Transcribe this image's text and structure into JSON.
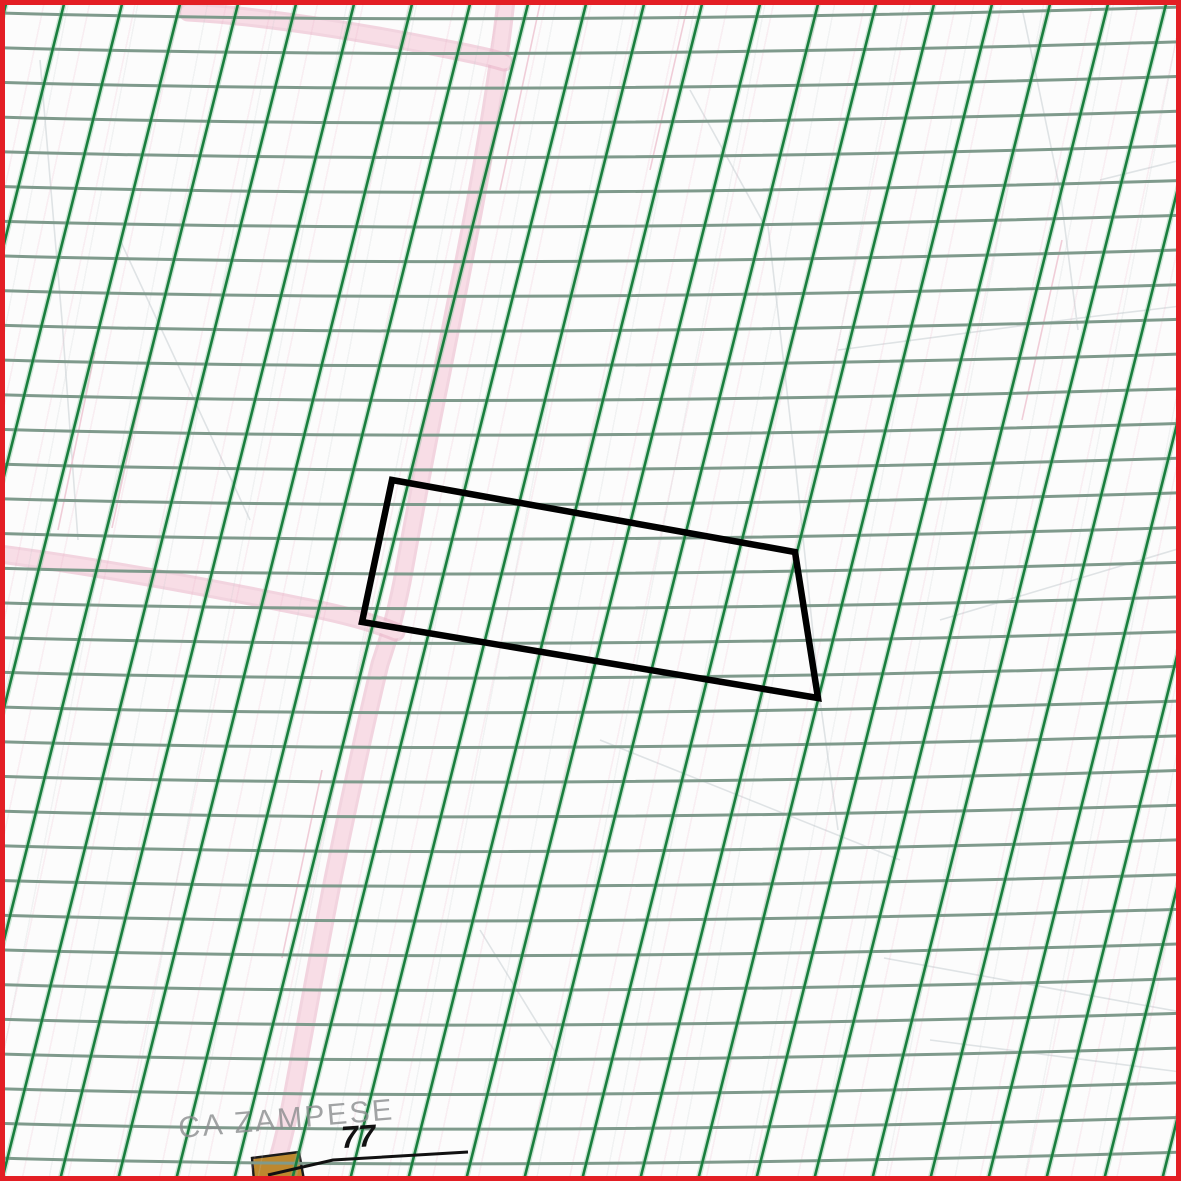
{
  "map": {
    "type": "cadastral-map-viewport",
    "labels": {
      "place": "CA ZAMPESE",
      "parcel_number": "77"
    },
    "colors": {
      "background": "#fcfcfc",
      "frame": "#e31e24",
      "grid_horizontal": "#7f9a8c",
      "grid_diagonal": "#1a7e3e",
      "grid_diagonal_halo": "rgba(105,185,135,0.32)",
      "road_fill": "#f8dde6",
      "road_edge": "#eab3c6",
      "selection_outline": "#000000",
      "leader": "#111111",
      "building_fill": "#bd882f",
      "building_outline": "#1a1a1a",
      "place_label": "#8b8d8f",
      "parcel_number": "#111111",
      "faint_gray": "#dfe3e5",
      "faint_pink": "#f0cdd8"
    },
    "grid": {
      "horizontal_spacing": 34.7,
      "horizontal_width": 3,
      "horizontal_phase": 13,
      "diagonal_spacing_x": 58,
      "diagonal_slope": -4,
      "diagonal_width": 2.6,
      "diagonal_halo_width": 5.5,
      "diagonal_phase": 10
    },
    "selection_polygon_points": "392,480 795,552 818,698 362,622",
    "building_points": "252,1158 299,1152 304,1180 254,1181",
    "leader_points": "268,1175 333,1160 468,1152",
    "roads": [
      {
        "name": "road-main-north-south",
        "d": "M 506,0 C 492,130 462,270 442,372 C 428,440 416,505 402,582 C 394,622 386,646 380,664 C 366,722 348,806 334,874 C 320,944 304,1034 290,1108 C 283,1144 276,1166 271,1181"
      },
      {
        "name": "road-branch-top",
        "d": "M 188,12 C 262,16 362,32 442,48 C 468,53 492,58 504,62"
      },
      {
        "name": "road-branch-left",
        "d": "M 0,554 C 92,566 202,586 300,606 C 342,614 372,622 396,632"
      }
    ],
    "faint_lines": [
      {
        "d": "M 40,60 L 62,320 L 78,540",
        "tone": "gray"
      },
      {
        "d": "M 120,240 L 250,520",
        "tone": "gray"
      },
      {
        "d": "M 768,226 L 796,470 L 820,700 L 838,830",
        "tone": "gray"
      },
      {
        "d": "M 690,90 L 764,224",
        "tone": "gray"
      },
      {
        "d": "M 838,350 L 1080,318 L 1181,306",
        "tone": "gray"
      },
      {
        "d": "M 884,958 L 1181,1012",
        "tone": "gray"
      },
      {
        "d": "M 930,1040 L 1181,1072",
        "tone": "gray"
      },
      {
        "d": "M 1022,8 L 1060,190 L 1078,330",
        "tone": "gray"
      },
      {
        "d": "M 940,620 L 1181,548",
        "tone": "gray"
      },
      {
        "d": "M 480,930 L 560,1060",
        "tone": "gray"
      },
      {
        "d": "M 1100,180 L 1181,160",
        "tone": "gray"
      },
      {
        "d": "M 600,740 L 900,860",
        "tone": "gray"
      },
      {
        "d": "M 688,4 L 650,170",
        "tone": "pink"
      },
      {
        "d": "M 1062,240 L 1022,420",
        "tone": "pink"
      },
      {
        "d": "M 322,770 L 282,958",
        "tone": "pink"
      },
      {
        "d": "M 540,4 L 500,190",
        "tone": "pink"
      },
      {
        "d": "M 150,352 L 112,528",
        "tone": "pink"
      },
      {
        "d": "M 95,352 L 58,530",
        "tone": "pink"
      }
    ]
  }
}
